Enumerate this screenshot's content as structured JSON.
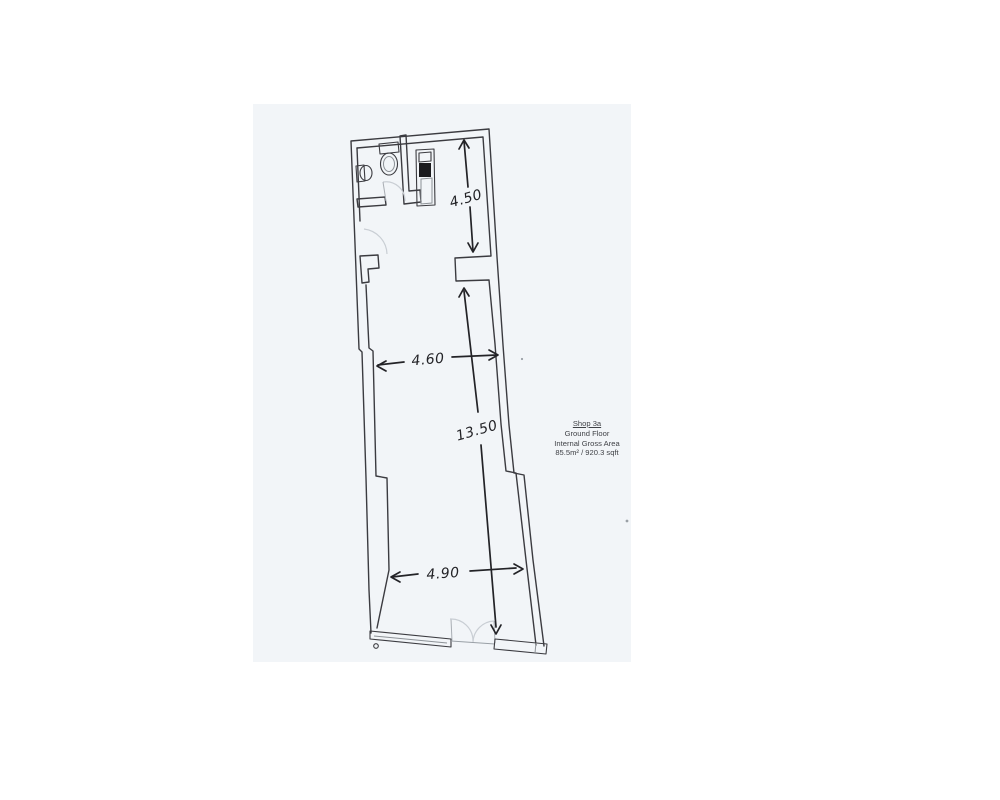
{
  "colors": {
    "page": "#ffffff",
    "paper": "#f2f5f8",
    "wall": "#3b3b40",
    "dim": "#232327",
    "arc": "#c9ced4",
    "leaf": "#a9aeb4",
    "text": "#404247",
    "fixture": "#1b1b1e"
  },
  "dimensions": {
    "rear_depth": "4.50",
    "mid_width": "4.60",
    "length": "13.50",
    "front_width": "4.90"
  },
  "info_block": {
    "title": "Shop 3a",
    "floor": "Ground Floor",
    "heading": "Internal Gross Area",
    "area": "85.5m² / 920.3 sqft"
  }
}
